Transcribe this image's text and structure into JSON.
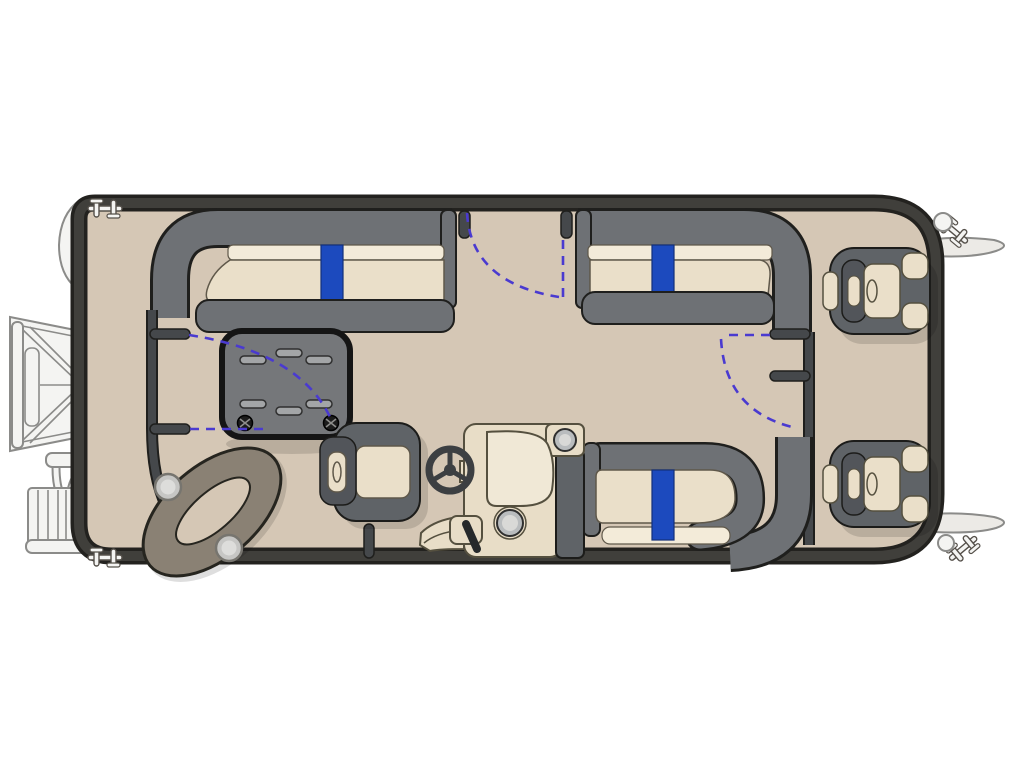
{
  "title": "Pontoon boat floorplan (top view)",
  "colors": {
    "pageBg": "#ffffff",
    "deck": "#d5c7b5",
    "hullEdge": "#23221f",
    "hullBand": "#403f3b",
    "fence": "#45484b",
    "seatFrame": "#6e7175",
    "frameEdge": "#1f1f1d",
    "cushion": "#eadfc9",
    "cushionLight": "#f3ebd9",
    "cushionEdge": "#5f584a",
    "accentBlue": "#1c4abe",
    "accentBlueEdge": "#12307a",
    "tableFill": "#75777a",
    "tableEdge": "#151515",
    "tableSlot": "#a3a5a7",
    "dash": "#4a3ad0",
    "lightGray": "#f4f4f2",
    "midStroke": "#8b8b89",
    "chairDark": "#5f6367",
    "headrest": "#52555a",
    "console": "#e8ddc7",
    "consolePanel": "#f0e8d6",
    "consoleEdge": "#55503f",
    "metal": "#b9bcbe",
    "screw": "#1c1c1c",
    "shadow": "rgba(0,0,0,0.13)"
  },
  "floorplan": {
    "type": "pontoon-boat-top-view",
    "orientation": "bow-right",
    "features": [
      "stern-boarding-ramp",
      "stern-boarding-ladder",
      "pontoon-tube-ends",
      "bow-nose-cone-fins",
      "mooring-cleats",
      "corner-lights",
      "port-aft-lounge-blue-accent",
      "port-forward-lounge-blue-accent",
      "aft-cocktail-table",
      "corner-step-pad-cupholders",
      "stern-gate-swing",
      "port-gate-swing",
      "bow-gate-swing",
      "helm-captain-chair",
      "steering-wheel",
      "helm-console-gauge-throttle",
      "starboard-lounge-blue-accent",
      "bow-fishing-chair-1",
      "bow-fishing-chair-2"
    ]
  }
}
